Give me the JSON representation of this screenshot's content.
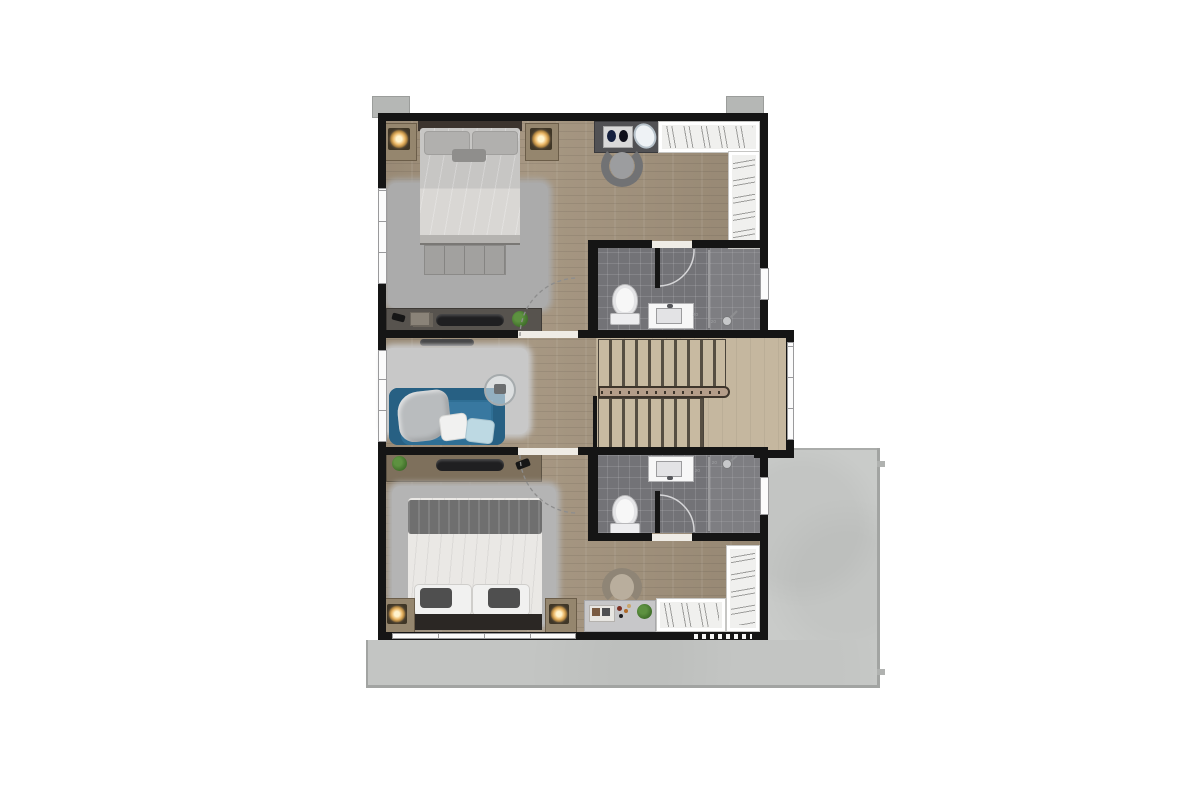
{
  "title": "Upper floor plan - two bedrooms with ensuite bathrooms, U-stair and terrace",
  "labels": {
    "drain_mark": "20"
  },
  "colors": {
    "wall": "#151515",
    "wood": "#a2927c",
    "stair_wood": "#c5b79f",
    "stair_tread": "#c8baa1",
    "stair_gap": "#564e42",
    "rail": "#b49d89",
    "rail_edge": "#3e352b",
    "tile": "#737377",
    "tile_light": "#7e7e82",
    "closet": "#f0f0ee",
    "closet_tick": "#9c9c9a",
    "terrace": "#c9cbc9",
    "terrace_edge": "#a2a4a2",
    "block": "#b5b7b5",
    "window": "#fbfbfb",
    "frame": "#9a9a9c",
    "rug1": "#ababab",
    "rug2": "#c8c8c8",
    "rug3": "#b4b4b4",
    "sofa": "#2f6f95",
    "sofa_dark": "#276083",
    "pillow_white": "#f1f1f0",
    "pillow_blue": "#bdd9e3",
    "blanket": "#b9bcbe",
    "duvet1": "#c7c6c4",
    "duvet1_light": "#d9d7d4",
    "pillow1": "#b1b0ae",
    "headboard": "#3c342e",
    "bench": "#a2a19f",
    "nightstand": "#95866e",
    "glow_center": "#fff3cd",
    "glow_mid": "#eab665",
    "glow_outer": "#4e4231",
    "console1": "#57534e",
    "console2": "#7e705c",
    "tv": "#1f1f21",
    "plant": "#47772f",
    "plant_dark": "#2f5c22",
    "duvet2": "#eae8e5",
    "throw2": "#6f6f6f",
    "pillow2_dark": "#4f4f4f",
    "frame2": "#2b2724",
    "desk2": "#c7c7c9",
    "chair2": "#8f8576",
    "chair2_seat": "#b9ae9d",
    "vanity": "#515154",
    "chair1": "#717274",
    "chair1_seat": "#9c9d9f",
    "fixture": "#f7f7f7",
    "basin": "#e3e3e5",
    "arc": "#d9d9db",
    "mark": "#9fa0a3",
    "threshold": "#efece6"
  },
  "diagram_data": {
    "type": "floor-plan",
    "floor": "upper-level",
    "rooms": [
      {
        "name": "master-bedroom",
        "position": "top-left",
        "furniture": [
          "double-bed-headboard-top",
          "nightstand-with-lamp-left",
          "nightstand-with-lamp-right",
          "shaggy-rug",
          "tufted-bench",
          "media-console",
          "remote",
          "books",
          "tv",
          "plant"
        ]
      },
      {
        "name": "dressing-area",
        "position": "top-right",
        "furniture": [
          "vanity-table",
          "perfume-tray",
          "oval-mirror",
          "vanity-chair",
          "l-shaped-walk-in-closet"
        ]
      },
      {
        "name": "ensuite-bathroom-1",
        "position": "right-upper",
        "fixtures": [
          "toilet",
          "sink-counter",
          "walk-in-shower",
          "door-swing",
          "window"
        ]
      },
      {
        "name": "family-hall",
        "position": "middle-left",
        "furniture": [
          "blue-sofa",
          "throw-blanket",
          "white-pillow",
          "blue-pillow",
          "round-glass-table",
          "shaggy-rug",
          "wall-tv"
        ]
      },
      {
        "name": "staircase",
        "position": "middle-right",
        "features": [
          "upper-flight",
          "lower-flight",
          "central-handrail",
          "landing",
          "window"
        ]
      },
      {
        "name": "ensuite-bathroom-2",
        "position": "right-lower",
        "fixtures": [
          "toilet",
          "sink-counter",
          "walk-in-shower",
          "door-swing",
          "window"
        ]
      },
      {
        "name": "bedroom-2",
        "position": "bottom",
        "furniture": [
          "double-bed-headboard-bottom",
          "nightstand-with-lamp-left",
          "nightstand-with-lamp-right",
          "shaggy-rug",
          "media-console",
          "plant",
          "remote",
          "desk",
          "desk-chair",
          "l-shaped-walk-in-closet"
        ]
      },
      {
        "name": "terrace",
        "position": "right",
        "features": [
          "concrete-deck"
        ]
      },
      {
        "name": "balcony-strip",
        "position": "bottom",
        "features": [
          "concrete-deck"
        ]
      }
    ],
    "openings": {
      "bedroom_doors": 2,
      "bathroom_doors": 2,
      "windows": 7,
      "dashed_vent": 1,
      "exterior_columns": 2
    }
  }
}
